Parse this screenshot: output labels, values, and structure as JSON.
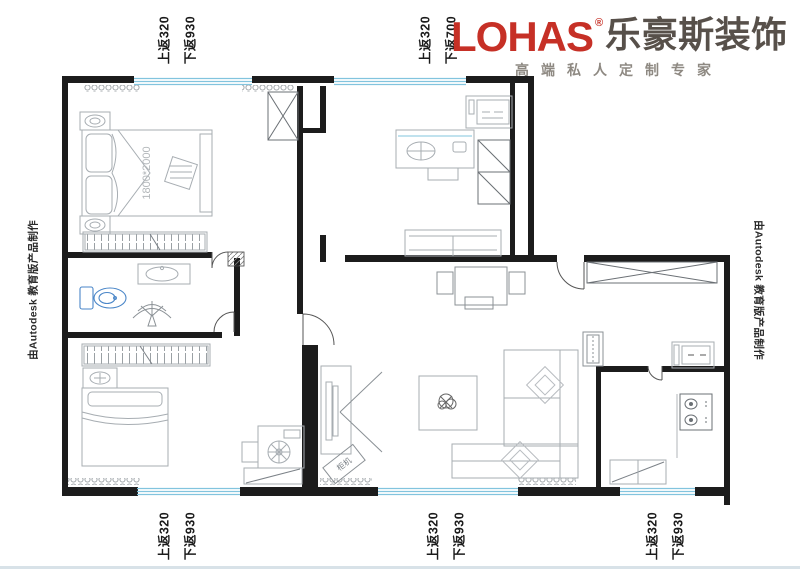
{
  "logo": {
    "brand": "LOHAS",
    "reg": "®",
    "brand_cn": "乐豪斯装饰",
    "tagline": "高端私人定制专家",
    "brand_color": "#c63026",
    "brand_cn_color": "#57504a",
    "tagline_color": "#8e8982"
  },
  "annotations": {
    "top_left": [
      "上返320",
      "下返930"
    ],
    "top_middle": [
      "上返320",
      "下返700"
    ],
    "bottom_left": [
      "上返320",
      "下返930"
    ],
    "bottom_middle": [
      "上返320",
      "下返930"
    ],
    "bottom_right": [
      "上返320",
      "下返930"
    ],
    "side_left": "由Autodesk 教育版产品制作",
    "side_right": "由Autodesk 教育版产品制作"
  },
  "plan": {
    "bed_label": "1800*2000",
    "ac_label": "柜机",
    "colors": {
      "wall": "#1c1c1c",
      "furniture": "#a7adb2",
      "window": "#82c4de",
      "fixture": "#4a86c8"
    }
  }
}
